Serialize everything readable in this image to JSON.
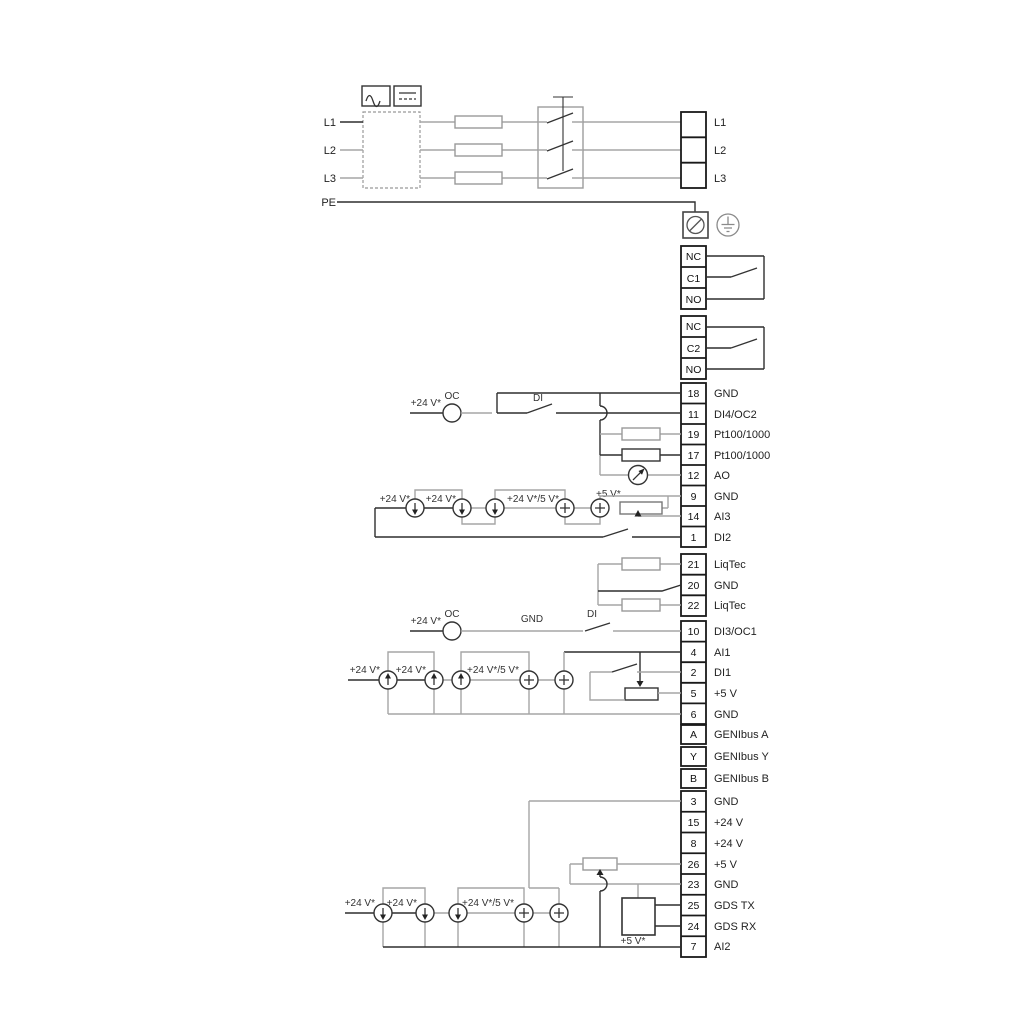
{
  "colors": {
    "wire_gray": "#a6a6a6",
    "wire_black": "#2f2f2f",
    "border": "#1a1a1a",
    "bg": "#ffffff"
  },
  "power": {
    "inputs": [
      "L1",
      "L2",
      "L3",
      "PE"
    ],
    "outputs": [
      "L1",
      "L2",
      "L3"
    ]
  },
  "relays": {
    "relay1": [
      "NC",
      "C1",
      "NO"
    ],
    "relay2": [
      "NC",
      "C2",
      "NO"
    ]
  },
  "blocks": {
    "io1": [
      {
        "n": "18",
        "t": "GND"
      },
      {
        "n": "11",
        "t": "DI4/OC2"
      },
      {
        "n": "19",
        "t": "Pt100/1000"
      },
      {
        "n": "17",
        "t": "Pt100/1000"
      },
      {
        "n": "12",
        "t": "AO"
      },
      {
        "n": "9",
        "t": "GND"
      },
      {
        "n": "14",
        "t": "AI3"
      },
      {
        "n": "1",
        "t": "DI2"
      }
    ],
    "liqtec": [
      {
        "n": "21",
        "t": "LiqTec"
      },
      {
        "n": "20",
        "t": "GND"
      },
      {
        "n": "22",
        "t": "LiqTec"
      }
    ],
    "io2": [
      {
        "n": "10",
        "t": "DI3/OC1"
      },
      {
        "n": "4",
        "t": "AI1"
      },
      {
        "n": "2",
        "t": "DI1"
      },
      {
        "n": "5",
        "t": "+5 V"
      },
      {
        "n": "6",
        "t": "GND"
      },
      {
        "n": "A",
        "t": "GENIbus A"
      },
      {
        "n": "Y",
        "t": "GENIbus Y"
      },
      {
        "n": "B",
        "t": "GENIbus B"
      }
    ],
    "io3": [
      {
        "n": "3",
        "t": "GND"
      },
      {
        "n": "15",
        "t": "+24 V"
      },
      {
        "n": "8",
        "t": "+24 V"
      },
      {
        "n": "26",
        "t": "+5 V"
      },
      {
        "n": "23",
        "t": "GND"
      },
      {
        "n": "25",
        "t": "GDS TX"
      },
      {
        "n": "24",
        "t": "GDS RX"
      },
      {
        "n": "7",
        "t": "AI2"
      }
    ]
  },
  "ann": {
    "oc": "OC",
    "di": "DI",
    "gnd": "GND",
    "v24": "+24 V*",
    "v24_5": "+24 V*/5 V*",
    "v5": "+5 V*"
  }
}
